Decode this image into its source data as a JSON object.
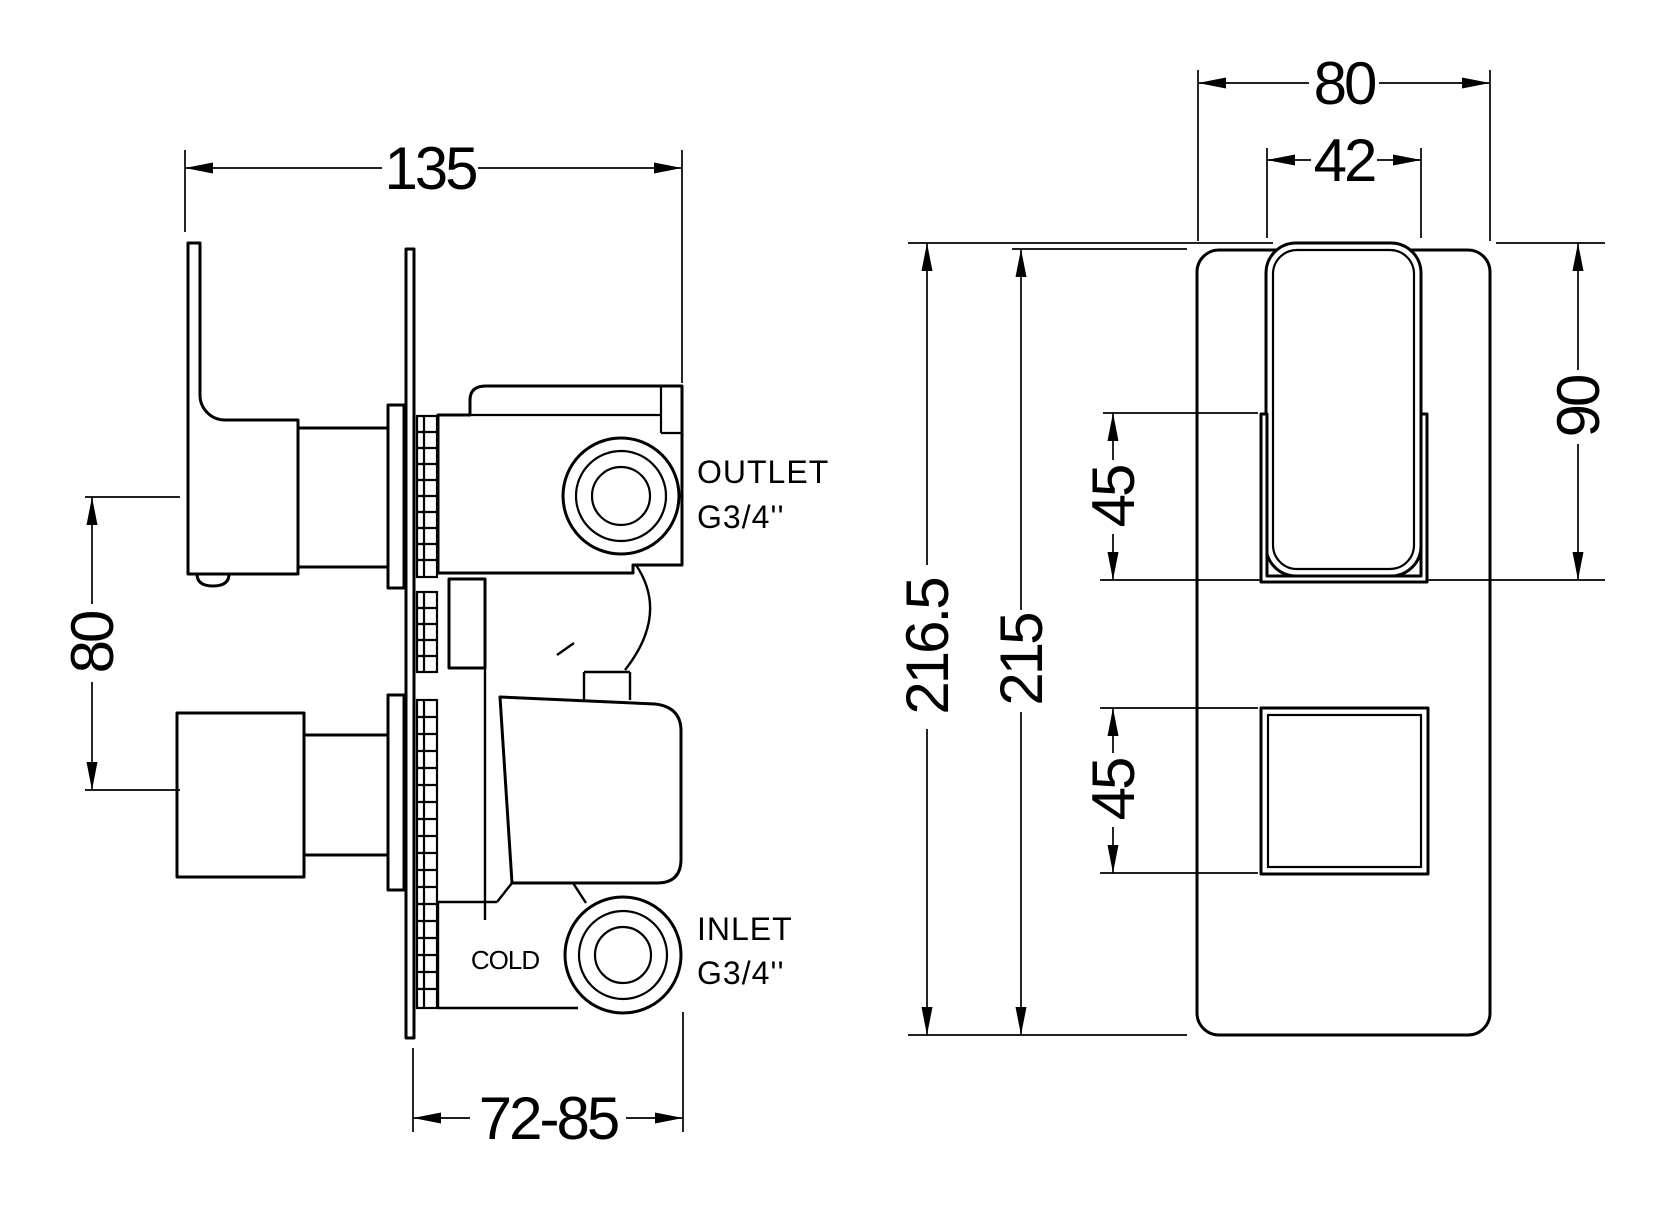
{
  "side_view": {
    "dims": {
      "width": "135",
      "spacing": "80",
      "depth": "72-85"
    },
    "labels": {
      "outlet": "OUTLET",
      "outlet_thread": "G3/4''",
      "inlet": "INLET",
      "inlet_thread": "G3/4''",
      "cold": "COLD"
    }
  },
  "front_view": {
    "dims": {
      "plate_width": "80",
      "handle_width": "42",
      "overall_height": "216.5",
      "plate_height": "215",
      "upper_offset": "45",
      "lower_offset": "45",
      "lever_height": "90"
    }
  },
  "colors": {
    "line": "#000000",
    "background": "#ffffff"
  }
}
